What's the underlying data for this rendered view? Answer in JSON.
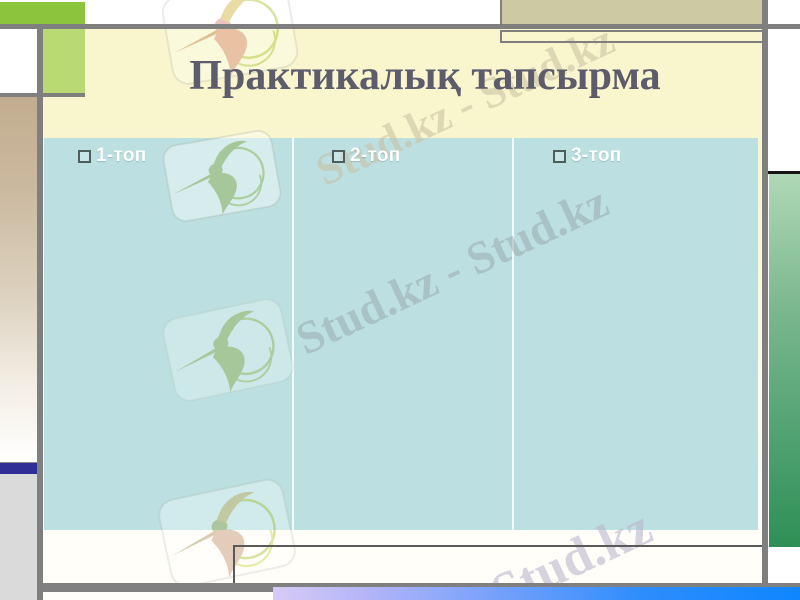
{
  "slide": {
    "title": "Практикалық тапсырма",
    "type_hint": "presentation-slide"
  },
  "content": {
    "columns": [
      {
        "label": "1-топ"
      },
      {
        "label": "2-топ"
      },
      {
        "label": "3-топ"
      }
    ]
  },
  "watermarks": {
    "title_band_text": "Stud.kz - Stud.kz",
    "content_text": "Stud.kz - Stud.kz",
    "bottom_text": "Stud.kz",
    "logo_name": "studkz-hummingbird-logo"
  },
  "colors": {
    "panel_teal": "#bce0e2",
    "title_gray": "#5c5c6c",
    "accent_green": "#8cc53c",
    "light_green": "#b9d973",
    "tan": "#ccc9a3",
    "navy": "#2e2e96",
    "frame_gray": "#7f7f7f",
    "right_green_top": "#afd8b7",
    "right_green_bottom": "#2e8f55",
    "bottom_blue": "#0e86ff",
    "bottom_lavender": "#d7cbf6",
    "body_yellow": "#f9f6cd"
  }
}
